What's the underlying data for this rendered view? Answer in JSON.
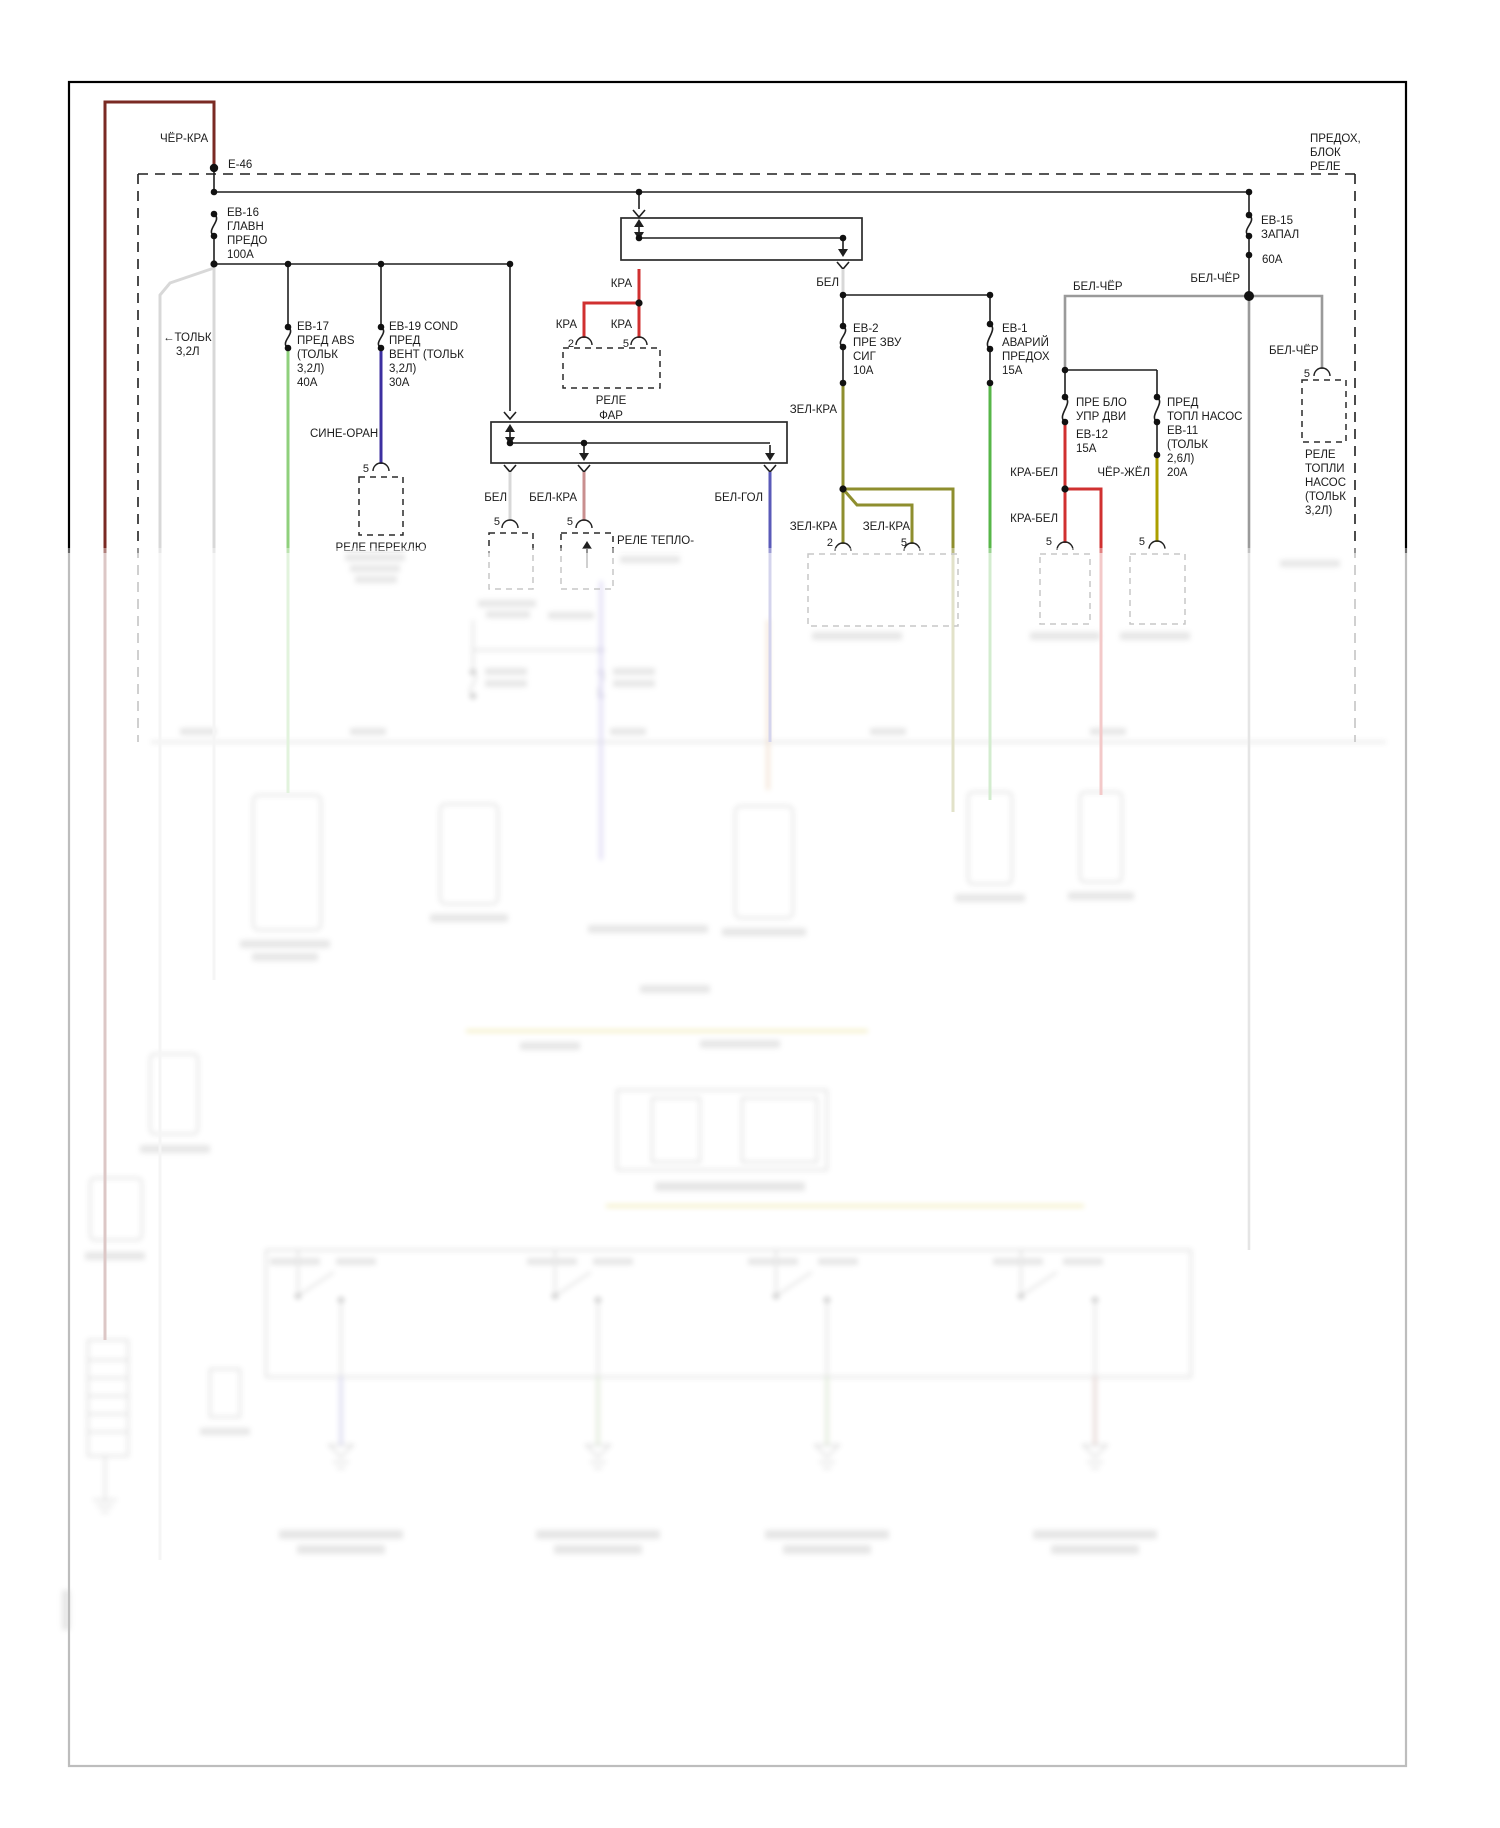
{
  "diagram": {
    "block_title": [
      "ПРЕДОХ,",
      "БЛОК",
      "РЕЛЕ"
    ],
    "ground_ref": "Е-46",
    "note_engine": [
      "←ТОЛЬК",
      "3,2Л"
    ],
    "fuses": {
      "eb16": [
        "ЕВ-16",
        "ГЛАВН",
        "ПРЕДО",
        "100А"
      ],
      "eb17": [
        "ЕВ-17",
        "ПРЕД ABS",
        "(ТОЛЬК",
        "3,2Л)",
        "40А"
      ],
      "eb19": [
        "ЕВ-19 COND",
        "ПРЕД",
        "ВЕНТ (ТОЛЬК",
        "3,2Л)",
        "30А"
      ],
      "eb15": [
        "ЕВ-15",
        "ЗАПАЛ",
        "60А"
      ],
      "eb2": [
        "ЕВ-2",
        "ПРЕ ЗВУ",
        "СИГ",
        "10А"
      ],
      "eb1": [
        "ЕВ-1",
        "АВАРИЙ",
        "ПРЕДОХ",
        "15А"
      ],
      "eb12": [
        "ПРЕ БЛО",
        "УПР ДВИ",
        "ЕВ-12",
        "15А"
      ],
      "eb11": [
        "ПРЕД",
        "ТОПЛ НАСОС",
        "ЕВ-11",
        "(ТОЛЬК",
        "2,6Л)",
        "20А"
      ]
    },
    "relays": {
      "far": [
        "РЕЛЕ",
        "ФАР"
      ],
      "pereklyu": "РЕЛЕ ПЕРЕКЛЮ",
      "teplo": "РЕЛЕ ТЕПЛО-",
      "topli_nasos": [
        "РЕЛЕ",
        "ТОПЛИ",
        "НАСОС",
        "(ТОЛЬК",
        "3,2Л)"
      ]
    },
    "wire_labels": {
      "cher_kra": "ЧЁР-КРА",
      "sine_oran": "СИНЕ-ОРАН",
      "kra": "КРА",
      "bel": "БЕЛ",
      "bel_kra": "БЕЛ-КРА",
      "bel_gol": "БЕЛ-ГОЛ",
      "zel_kra": "ЗЕЛ-КРА",
      "bel_cher": "БЕЛ-ЧЁР",
      "kra_bel": "КРА-БЕЛ",
      "cher_zhel": "ЧЁР-ЖЁЛ"
    },
    "pins": {
      "p2": "2",
      "p5": "5"
    },
    "wire_colors": {
      "cher_kra": "#7a2a23",
      "kra": "#d03030",
      "bel": "#d8d8d8",
      "bel_kra": "#c98f8f",
      "bel_gol": "#5a5ab8",
      "sine_oran": "#3c2fa0",
      "zel_kra_light": "#8fd07c",
      "zel_kra_green": "#57b648",
      "zel_kra_olive": "#8e8e2e",
      "bel_cher": "#9a9a9a",
      "cher_zhel": "#ab9f00"
    }
  }
}
